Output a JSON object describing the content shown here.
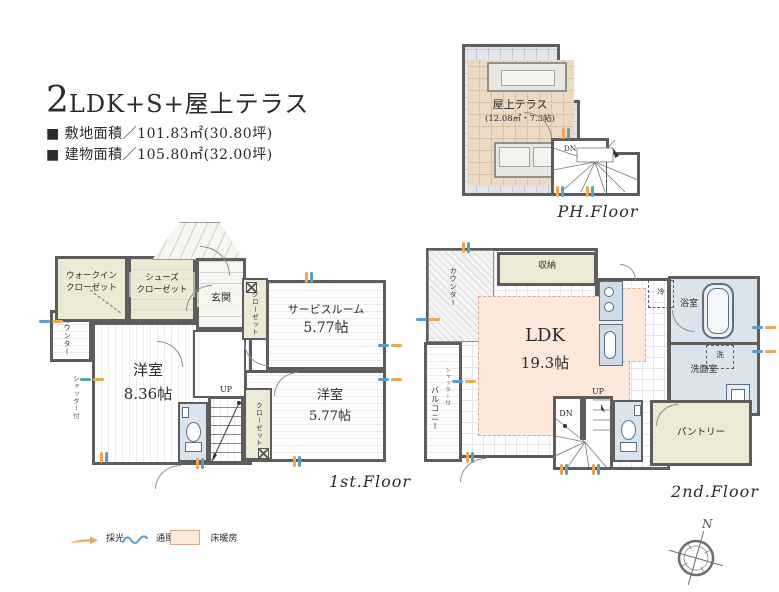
{
  "header": {
    "title_num": "2",
    "title_rest": "LDK+S+屋上テラス",
    "site_area": "■ 敷地面積／101.83㎡(30.80坪)",
    "building_area": "■ 建物面積／105.80㎡(32.00坪)"
  },
  "ph_floor": {
    "floor_label": "PH.Floor",
    "terrace_name": "屋上テラス",
    "terrace_area": "(12.08㎡・7.3帖)",
    "stair_down": "DN"
  },
  "first_floor": {
    "floor_label": "1st.Floor",
    "walk_in_closet": "ウォークイン\nクローゼット",
    "shoes_closet": "シューズ\nクローゼット",
    "entrance": "玄関",
    "counter": "カウンター",
    "shutter_note": "シャッター付",
    "bedroom_main": "洋室",
    "bedroom_main_size": "8.36帖",
    "closet_hall": "クローゼット",
    "service_room": "サービスルーム",
    "service_room_size": "5.77帖",
    "bedroom_second": "洋室",
    "bedroom_second_size": "5.77帖",
    "closet_bedroom": "クローゼット",
    "stair_up": "UP"
  },
  "second_floor": {
    "floor_label": "2nd.Floor",
    "ldk": "LDK",
    "ldk_size": "19.3帖",
    "storage": "収納",
    "counter": "カウンター",
    "balcony": "バルコニー",
    "balcony_shutter": "シャッター付",
    "bathroom": "浴室",
    "washroom": "洗面室",
    "washer": "洗",
    "fridge": "冷",
    "pantry": "パントリー",
    "stair_up": "UP",
    "stair_down": "DN"
  },
  "legend": {
    "daylight": "採光",
    "ventilation": "通風",
    "floor_heating": "床暖房"
  },
  "compass": {
    "north": "N"
  },
  "colors": {
    "wall": "#5d5d5d",
    "daylight_orange": "#efa64e",
    "ventilation_blue": "#5b9ccb",
    "floor_heating_pink": "#fce9dc",
    "sanitary_blue": "#d9e4ed",
    "closet_cream": "#ece9d5"
  }
}
